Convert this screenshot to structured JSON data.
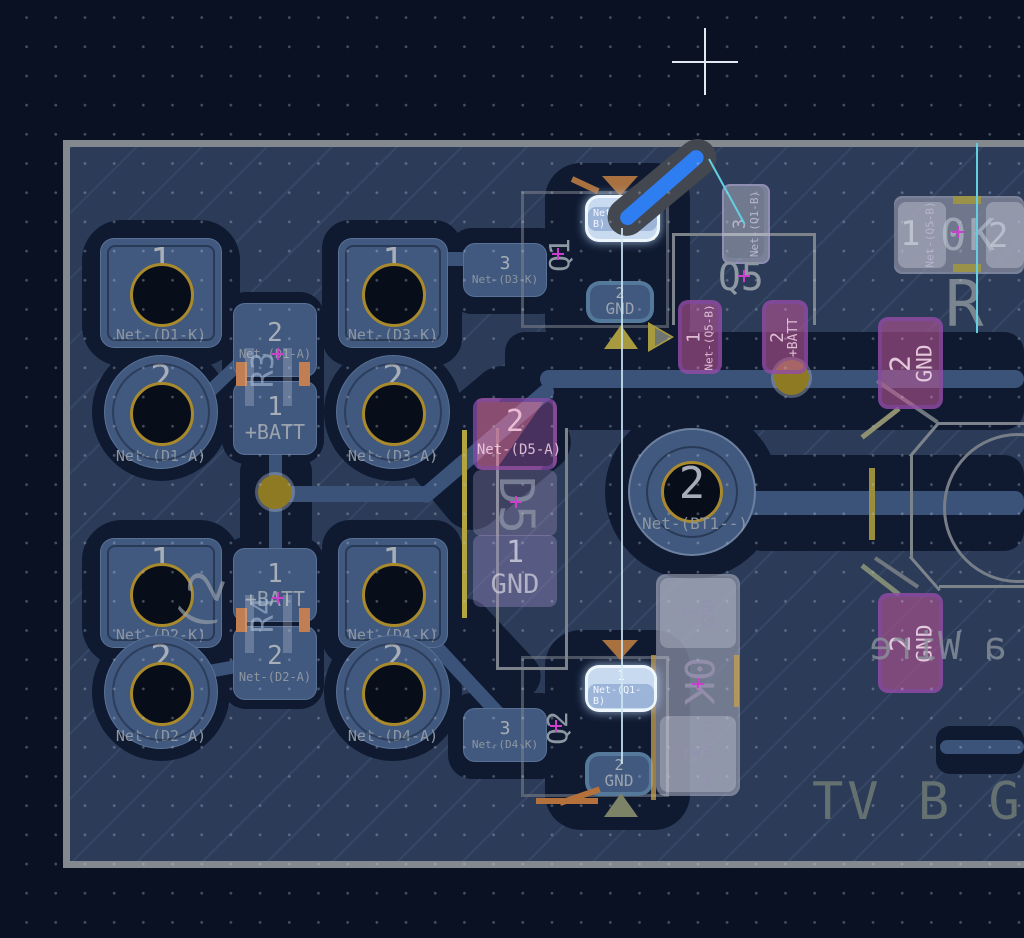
{
  "colors": {
    "route_active": "#2e7ef2",
    "ratsnest": "#63cfe0",
    "copper_front": "#41597f",
    "copper_back": "#ba56a0",
    "via_gold": "#8f7a24",
    "board_fill": "#2c3b58",
    "background": "#0a1122"
  },
  "pads": {
    "d1p1": {
      "num": "1",
      "net": "Net-(D1-K)"
    },
    "d1p2": {
      "num": "2",
      "net": "Net-(D1-A)"
    },
    "d2p1": {
      "num": "1",
      "net": "Net-(D2-K)"
    },
    "d2p2": {
      "num": "2",
      "net": "Net-(D2-A)"
    },
    "d3p1": {
      "num": "1",
      "net": "Net-(D3-K)"
    },
    "d3p2": {
      "num": "2",
      "net": "Net-(D3-A)"
    },
    "d3p3": {
      "num": "3",
      "net": "Net-(D3-K)"
    },
    "d4p1": {
      "num": "1",
      "net": "Net-(D4-K)"
    },
    "d4p2": {
      "num": "2",
      "net": "Net-(D4-A)"
    },
    "d4p3": {
      "num": "3",
      "net": "Net-(D4-K)"
    },
    "r3p2": {
      "num": "2",
      "net": "Net-(D1-A)"
    },
    "r3p1": {
      "num": "1",
      "net": "+BATT"
    },
    "r4p1": {
      "num": "1",
      "net": "+BATT"
    },
    "r4p2": {
      "num": "2",
      "net": "Net-(D2-A)"
    },
    "q1p1": {
      "net": "Net-(Q1-B)"
    },
    "q1p2": {
      "num": "2",
      "net": "GND"
    },
    "q2p1": {
      "num": "1",
      "net": "Net-(Q1-B)"
    },
    "q2p2": {
      "num": "2",
      "net": "GND"
    },
    "q5p3": {
      "num": "3",
      "net": "Net-(Q1-B)"
    },
    "q5p1": {
      "num": "1",
      "net": "Net-(Q5-B)"
    },
    "q5p2": {
      "num": "2",
      "net": "+BATT"
    },
    "d5p2": {
      "num": "2",
      "net": "Net-(D5-A)"
    },
    "d5p1": {
      "num": "1",
      "net": "GND"
    },
    "r5p1": {
      "num": "1",
      "net": "Net-(Q5-B)"
    },
    "r5p2": {
      "num": "2"
    },
    "bt1p2": {
      "num": "2",
      "net": "Net-(BT1--)"
    },
    "gndTop": {
      "num": "2",
      "net": "GND"
    },
    "gndBot": {
      "num": "2",
      "net": "GND"
    },
    "rbp1": {
      "num": "1",
      "net": "GND"
    },
    "rbp2": {
      "num": "2",
      "net": "Net-(Q1-B)"
    }
  },
  "refs": {
    "r3": "R3",
    "r4": "R4",
    "q1": "Q1",
    "q2": "Q2",
    "q5": "Q5",
    "d5": "D5",
    "r5_ref": "R",
    "r5_value": "0K",
    "rb_value": "0K"
  },
  "silkscreen": {
    "board_text": "TV B G",
    "mirrored_text": "a Wire",
    "d2_mark": "(2"
  }
}
